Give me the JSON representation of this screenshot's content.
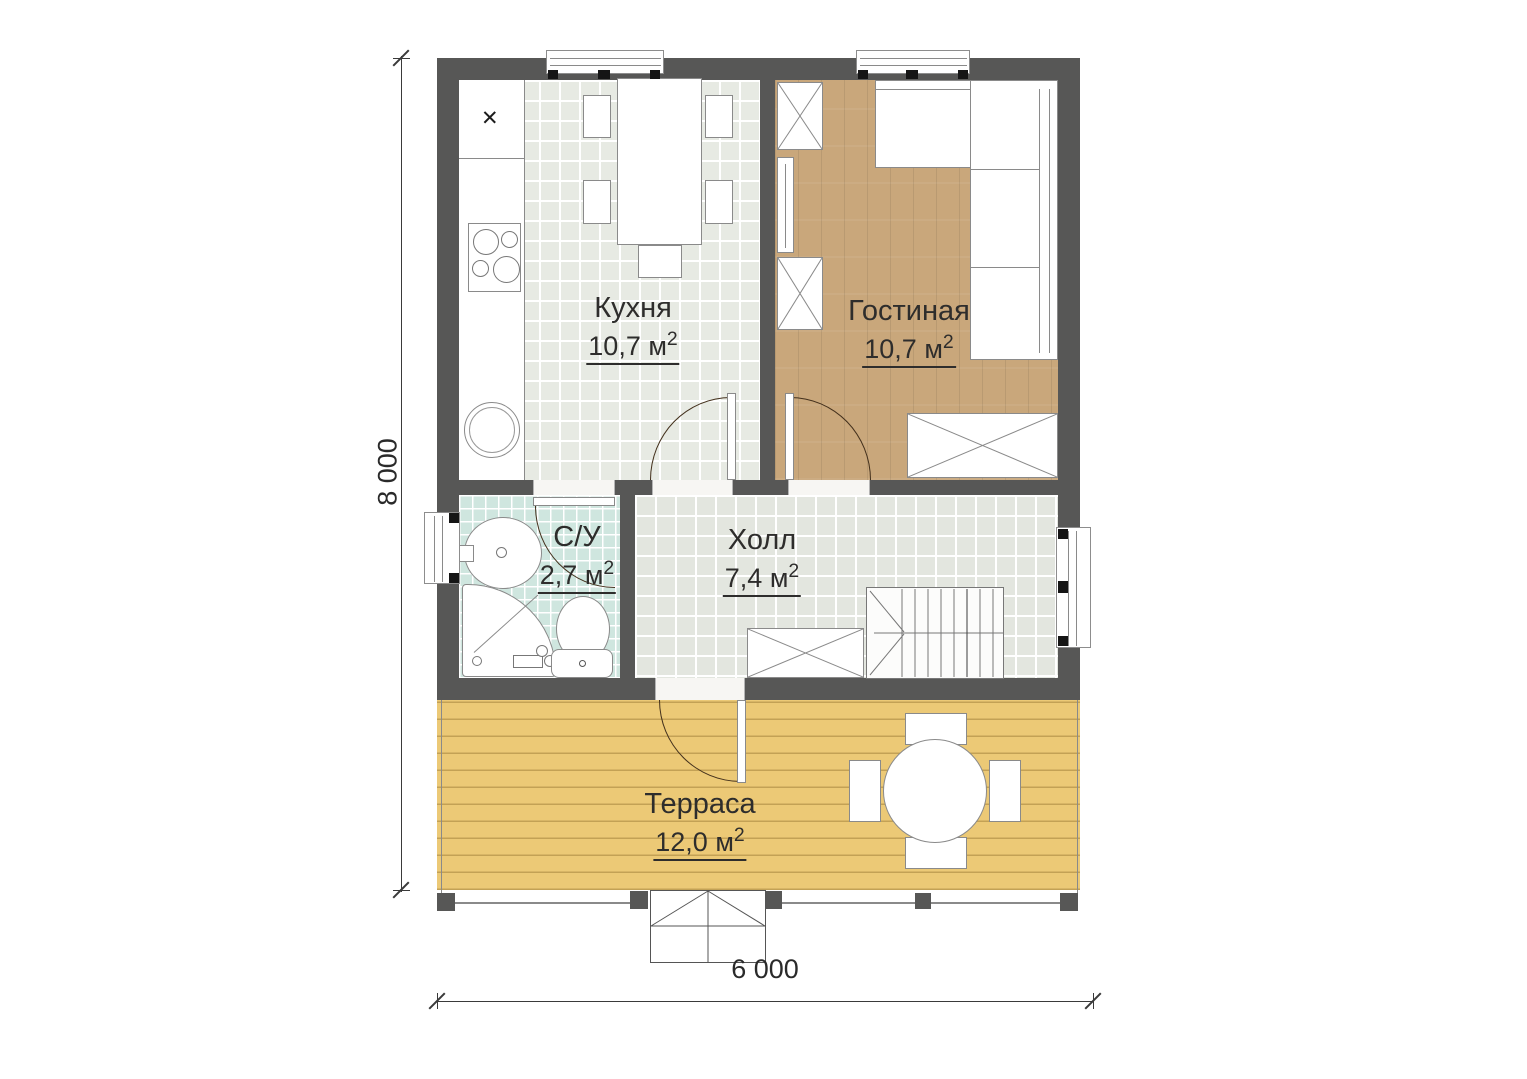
{
  "colors": {
    "wall": "#575756",
    "furniture_line": "#8a8a8a",
    "door_line": "#43301c",
    "text": "#2e2d2c",
    "kitchen_tile": "#e7eae3",
    "hall_tile": "#e3e6df",
    "bath_tile": "#cfe6df",
    "living_wood": "#c9a77b",
    "terrace_wood": "#ecc976",
    "terrace_wood_line": "#c3a155",
    "window_black": "#151515"
  },
  "rooms": {
    "kitchen": {
      "name": "Кухня",
      "area": "10,7 м",
      "area_sup": "2"
    },
    "living": {
      "name": "Гостиная",
      "area": "10,7 м",
      "area_sup": "2"
    },
    "bathroom": {
      "name": "С/У",
      "area": "2,7 м",
      "area_sup": "2"
    },
    "hall": {
      "name": "Холл",
      "area": "7,4 м",
      "area_sup": "2"
    },
    "terrace": {
      "name": "Терраса",
      "area": "12,0 м",
      "area_sup": "2"
    }
  },
  "dimensions": {
    "overall_width": "6 000",
    "overall_depth": "8 000"
  },
  "icons": {
    "sink_cross": "✕"
  }
}
